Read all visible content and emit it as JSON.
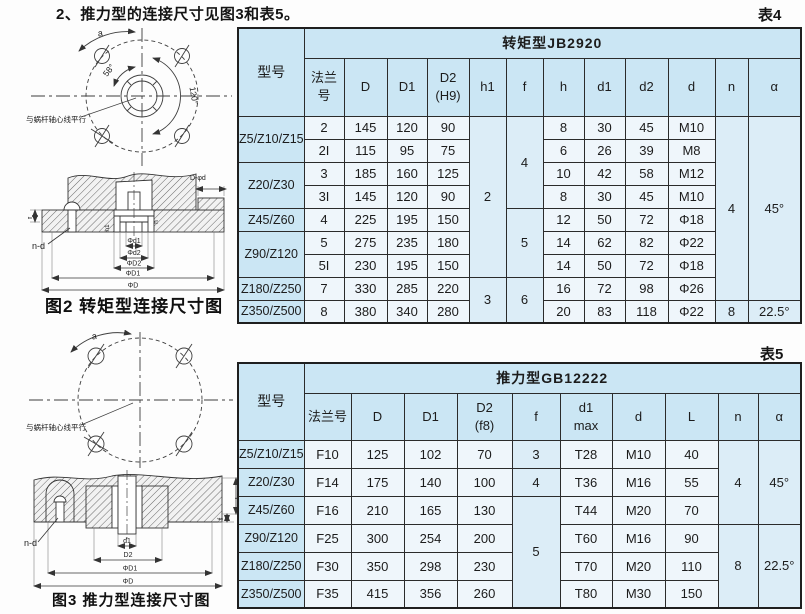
{
  "page": {
    "title": "2、推力型的连接尺寸见图3和表5。",
    "table4_tag": "表4",
    "table5_tag": "表5"
  },
  "figure2": {
    "caption": "图2 转矩型连接尺寸图",
    "labels": {
      "a": "a",
      "angle_small": "58°",
      "angle_large": "120°",
      "note": "与蜗杆轴心线平行",
      "bolt": "n-d",
      "f": "f",
      "top_step": "D-φd",
      "h1": "h1",
      "h": "h"
    },
    "dims": [
      "Φd1",
      "Φd2",
      "ΦD2",
      "ΦD1",
      "ΦD"
    ]
  },
  "figure3": {
    "caption": "图3 推力型连接尺寸图",
    "labels": {
      "a": "a",
      "note": "与蜗杆轴心线平行",
      "bolt": "n-d",
      "L": "L",
      "f": "f"
    },
    "dims": [
      "d1",
      "D2",
      "ΦD1",
      "ΦD"
    ]
  },
  "tables": {
    "table4": {
      "corner": "型号",
      "group_header": "转矩型JB2920",
      "headers": [
        "法兰\n号",
        "D",
        "D1",
        "D2\n(H9)",
        "h1",
        "f",
        "h",
        "d1",
        "d2",
        "d",
        "n",
        "α"
      ],
      "rows": [
        [
          {
            "t": "Z5/Z10/Z15",
            "k": "model",
            "rs": 2
          },
          {
            "t": "2"
          },
          {
            "t": "145"
          },
          {
            "t": "120"
          },
          {
            "t": "90"
          },
          {
            "t": "2",
            "k": "tint",
            "rs": 7
          },
          {
            "t": "4",
            "k": "tint",
            "rs": 4
          },
          {
            "t": "8"
          },
          {
            "t": "30"
          },
          {
            "t": "45"
          },
          {
            "t": "M10"
          },
          {
            "t": "4",
            "k": "tint",
            "rs": 8
          },
          {
            "t": "45°",
            "k": "tint",
            "rs": 8
          }
        ],
        [
          {
            "t": "2I"
          },
          {
            "t": "115"
          },
          {
            "t": "95"
          },
          {
            "t": "75"
          },
          {
            "t": "6"
          },
          {
            "t": "26"
          },
          {
            "t": "39"
          },
          {
            "t": "M8"
          }
        ],
        [
          {
            "t": "Z20/Z30",
            "k": "model",
            "rs": 2
          },
          {
            "t": "3"
          },
          {
            "t": "185"
          },
          {
            "t": "160"
          },
          {
            "t": "125"
          },
          {
            "t": "10"
          },
          {
            "t": "42"
          },
          {
            "t": "58"
          },
          {
            "t": "M12"
          }
        ],
        [
          {
            "t": "3I"
          },
          {
            "t": "145"
          },
          {
            "t": "120"
          },
          {
            "t": "90"
          },
          {
            "t": "8"
          },
          {
            "t": "30"
          },
          {
            "t": "45"
          },
          {
            "t": "M10"
          }
        ],
        [
          {
            "t": "Z45/Z60",
            "k": "model"
          },
          {
            "t": "4"
          },
          {
            "t": "225"
          },
          {
            "t": "195"
          },
          {
            "t": "150"
          },
          {
            "t": "5",
            "k": "tint",
            "rs": 3
          },
          {
            "t": "12"
          },
          {
            "t": "50"
          },
          {
            "t": "72"
          },
          {
            "t": "Φ18"
          }
        ],
        [
          {
            "t": "Z90/Z120",
            "k": "model",
            "rs": 2
          },
          {
            "t": "5"
          },
          {
            "t": "275"
          },
          {
            "t": "235"
          },
          {
            "t": "180"
          },
          {
            "t": "14"
          },
          {
            "t": "62"
          },
          {
            "t": "82"
          },
          {
            "t": "Φ22"
          }
        ],
        [
          {
            "t": "5I"
          },
          {
            "t": "230"
          },
          {
            "t": "195"
          },
          {
            "t": "150"
          },
          {
            "t": "14"
          },
          {
            "t": "50"
          },
          {
            "t": "72"
          },
          {
            "t": "Φ18"
          }
        ],
        [
          {
            "t": "Z180/Z250",
            "k": "model"
          },
          {
            "t": "7"
          },
          {
            "t": "330"
          },
          {
            "t": "285"
          },
          {
            "t": "220"
          },
          {
            "t": "3",
            "k": "tint",
            "rs": 2
          },
          {
            "t": "6",
            "k": "tint",
            "rs": 2
          },
          {
            "t": "16"
          },
          {
            "t": "72"
          },
          {
            "t": "98"
          },
          {
            "t": "Φ26"
          }
        ],
        [
          {
            "t": "Z350/Z500",
            "k": "model"
          },
          {
            "t": "8"
          },
          {
            "t": "380"
          },
          {
            "t": "340"
          },
          {
            "t": "280"
          },
          {
            "t": "20"
          },
          {
            "t": "83"
          },
          {
            "t": "118"
          },
          {
            "t": "Φ22"
          },
          {
            "t": "8",
            "k": "tint"
          },
          {
            "t": "22.5°",
            "k": "tint"
          }
        ]
      ]
    },
    "table5": {
      "corner": "型号",
      "group_header": "推力型GB12222",
      "headers": [
        "法兰号",
        "D",
        "D1",
        "D2\n(f8)",
        "f",
        "d1\nmax",
        "d",
        "L",
        "n",
        "α"
      ],
      "rows": [
        [
          {
            "t": "Z5/Z10/Z15",
            "k": "model"
          },
          {
            "t": "F10"
          },
          {
            "t": "125"
          },
          {
            "t": "102"
          },
          {
            "t": "70"
          },
          {
            "t": "3",
            "k": "tint"
          },
          {
            "t": "T28"
          },
          {
            "t": "M10"
          },
          {
            "t": "40"
          },
          {
            "t": "4",
            "k": "tint",
            "rs": 3
          },
          {
            "t": "45°",
            "k": "tint",
            "rs": 3
          }
        ],
        [
          {
            "t": "Z20/Z30",
            "k": "model"
          },
          {
            "t": "F14"
          },
          {
            "t": "175"
          },
          {
            "t": "140"
          },
          {
            "t": "100"
          },
          {
            "t": "4",
            "k": "tint"
          },
          {
            "t": "T36"
          },
          {
            "t": "M16"
          },
          {
            "t": "55"
          }
        ],
        [
          {
            "t": "Z45/Z60",
            "k": "model"
          },
          {
            "t": "F16"
          },
          {
            "t": "210"
          },
          {
            "t": "165"
          },
          {
            "t": "130"
          },
          {
            "t": "5",
            "k": "tint",
            "rs": 4
          },
          {
            "t": "T44"
          },
          {
            "t": "M20"
          },
          {
            "t": "70"
          }
        ],
        [
          {
            "t": "Z90/Z120",
            "k": "model"
          },
          {
            "t": "F25"
          },
          {
            "t": "300"
          },
          {
            "t": "254"
          },
          {
            "t": "200"
          },
          {
            "t": "T60"
          },
          {
            "t": "M16"
          },
          {
            "t": "90"
          },
          {
            "t": "8",
            "k": "tint",
            "rs": 3
          },
          {
            "t": "22.5°",
            "k": "tint",
            "rs": 3
          }
        ],
        [
          {
            "t": "Z180/Z250",
            "k": "model"
          },
          {
            "t": "F30"
          },
          {
            "t": "350"
          },
          {
            "t": "298"
          },
          {
            "t": "230"
          },
          {
            "t": "T70"
          },
          {
            "t": "M20"
          },
          {
            "t": "110"
          }
        ],
        [
          {
            "t": "Z350/Z500",
            "k": "model"
          },
          {
            "t": "F35"
          },
          {
            "t": "415"
          },
          {
            "t": "356"
          },
          {
            "t": "260"
          },
          {
            "t": "T80"
          },
          {
            "t": "M30"
          },
          {
            "t": "150"
          }
        ]
      ]
    }
  }
}
